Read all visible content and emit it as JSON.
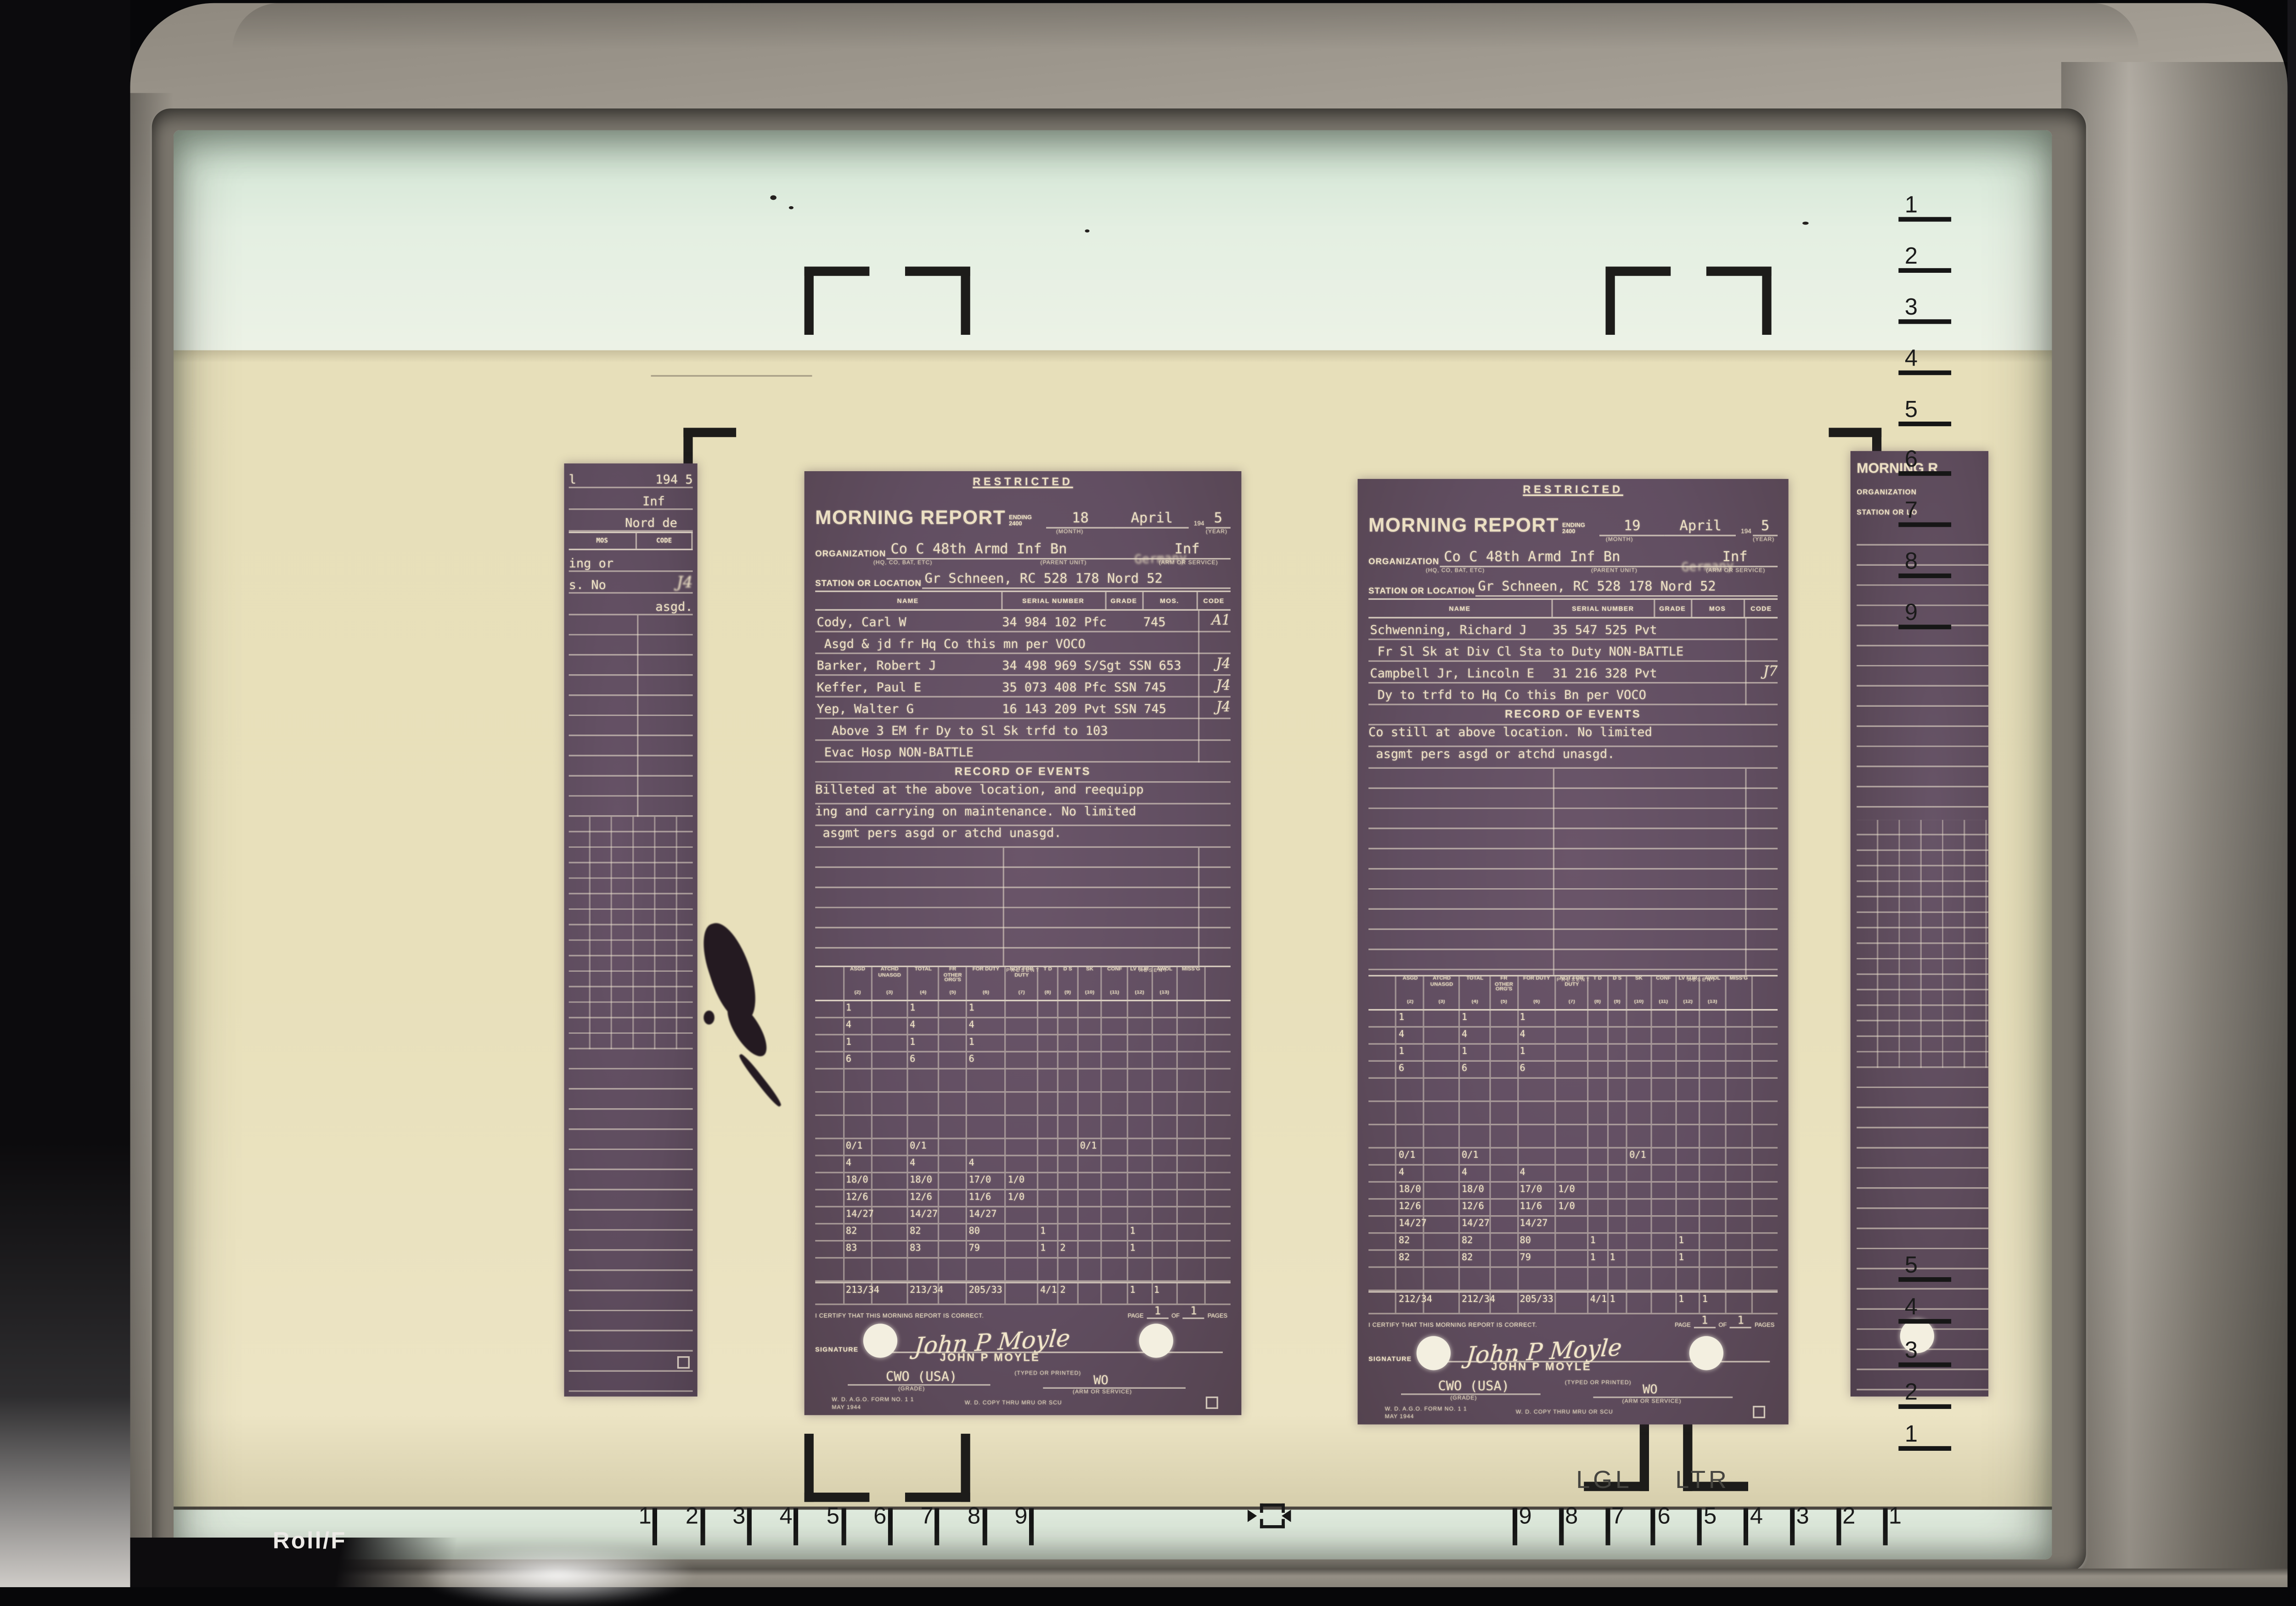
{
  "machine": {
    "roll_label": "Roll/F",
    "lgl": "LGL",
    "ltr": "LTR"
  },
  "rulers": {
    "bottom_left": [
      "1",
      "2",
      "3",
      "4",
      "5",
      "6",
      "7",
      "8",
      "9"
    ],
    "bottom_right": [
      "9",
      "8",
      "7",
      "6",
      "5",
      "4",
      "3",
      "2",
      "1"
    ],
    "right_top": [
      "1",
      "2",
      "3",
      "4",
      "5",
      "6",
      "7",
      "8",
      "9"
    ],
    "right_bottom": [
      "5",
      "4",
      "3",
      "2",
      "1"
    ]
  },
  "stats_common": {
    "present": "PRESENT",
    "absent": "ABSENT",
    "cols": [
      "ASGD",
      "ATCHD UNASGD",
      "TOTAL",
      "FR OTHER ORG'S",
      "FOR DUTY",
      "NOT FOR DUTY",
      "T D",
      "D S",
      "SK",
      "CONF",
      "LV FUR",
      "AWOL",
      "MISS'G"
    ],
    "nums": [
      "(2)",
      "(3)",
      "(4)",
      "(5)",
      "(6)",
      "(7)",
      "(8)",
      "(9)",
      "(10)",
      "(11)",
      "(12)",
      "(13)"
    ]
  },
  "doc1": {
    "classification": "RESTRICTED",
    "title": "MORNING REPORT",
    "ending": "ENDING 2400",
    "day": "18",
    "month": "April",
    "year_prefix": "194",
    "year": "5",
    "month_label": "(MONTH)",
    "year_label": "(YEAR)",
    "org_label": "ORGANIZATION",
    "org": "Co C 48th Armd Inf Bn",
    "org_sub": "(HQ, CO, BAT, ETC)",
    "parent_label": "(PARENT UNIT)",
    "arm": "Inf",
    "arm_label": "(ARM OR SERVICE)",
    "overstrike": "Germany",
    "station_label": "STATION OR LOCATION",
    "station": "Gr Schneen, RC 528 178 Nord 52",
    "cols": [
      "NAME",
      "SERIAL NUMBER",
      "GRADE",
      "MOS.",
      "CODE"
    ],
    "roster": [
      {
        "name": "Cody, Carl W",
        "serial": "34 984 102 Pfc",
        "mos": "745",
        "code": "A1"
      },
      {
        "name": " Asgd & jd fr Hq Co this mn per VOCO"
      },
      {
        "name": "Barker, Robert J",
        "serial": "34 498 969 S/Sgt SSN 653",
        "code": "J4"
      },
      {
        "name": "Keffer, Paul E",
        "serial": "35 073 408 Pfc SSN 745",
        "code": "J4"
      },
      {
        "name": "Yep, Walter G",
        "serial": "16 143 209 Pvt SSN 745",
        "code": "J4"
      },
      {
        "name": "  Above 3 EM fr Dy to Sl Sk trfd to 103"
      },
      {
        "name": " Evac Hosp NON-BATTLE"
      }
    ],
    "events_title": "RECORD OF EVENTS",
    "events": [
      "Billeted at the above location, and reequipp",
      "ing and carrying on maintenance. No limited",
      " asgmt pers asgd or atchd unasgd."
    ],
    "stats_rows": [
      [
        "1",
        "",
        "1",
        "",
        "1",
        "",
        "",
        "",
        "",
        "",
        "",
        "",
        ""
      ],
      [
        "4",
        "",
        "4",
        "",
        "4",
        "",
        "",
        "",
        "",
        "",
        "",
        "",
        ""
      ],
      [
        "1",
        "",
        "1",
        "",
        "1",
        "",
        "",
        "",
        "",
        "",
        "",
        "",
        ""
      ],
      [
        "6",
        "",
        "6",
        "",
        "6",
        "",
        "",
        "",
        "",
        "",
        "",
        "",
        ""
      ],
      [],
      [],
      [],
      [
        "0/1",
        "",
        "0/1",
        "",
        "",
        "",
        "",
        "",
        "0/1",
        "",
        "",
        "",
        ""
      ],
      [
        "4",
        "",
        "4",
        "",
        "4",
        "",
        "",
        "",
        "",
        "",
        "",
        "",
        ""
      ],
      [
        "18/0",
        "",
        "18/0",
        "",
        "17/0",
        "1/0",
        "",
        "",
        "",
        "",
        "",
        "",
        ""
      ],
      [
        "12/6",
        "",
        "12/6",
        "",
        "11/6",
        "1/0",
        "",
        "",
        "",
        "",
        "",
        "",
        ""
      ],
      [
        "14/27",
        "",
        "14/27",
        "",
        "14/27",
        "",
        "",
        "",
        "",
        "",
        "",
        "",
        ""
      ],
      [
        "82",
        "",
        "82",
        "",
        "80",
        "",
        "1",
        "",
        "",
        "",
        "1",
        "",
        ""
      ],
      [
        "83",
        "",
        "83",
        "",
        "79",
        "",
        "1",
        "2",
        "",
        "",
        "1",
        "",
        ""
      ],
      [],
      [
        "213/34",
        "",
        "213/34",
        "",
        "205/33",
        "",
        "4/1",
        "2",
        "",
        "",
        "1",
        "1",
        ""
      ]
    ],
    "certify": "I CERTIFY THAT THIS MORNING REPORT IS CORRECT.",
    "page_label": "PAGE",
    "page": "1",
    "of_label": "OF",
    "pages": "1",
    "pages_label": "PAGES",
    "signature_label": "SIGNATURE",
    "sig_script": "John P Moyle",
    "sig_typed": "JOHN P MOYLE",
    "typed_note": "(TYPED OR PRINTED)",
    "grade": "CWO (USA)",
    "grade_label": "(GRADE)",
    "svc": "WO",
    "svc_label": "(ARM OR SERVICE)",
    "form_no": "W. D. A.G.O. FORM NO. 1",
    "form_rev": "1 MAY 1944",
    "copy_note": "W. D. COPY THRU MRU OR SCU"
  },
  "doc2": {
    "classification": "RESTRICTED",
    "title": "MORNING REPORT",
    "ending": "ENDING 2400",
    "day": "19",
    "month": "April",
    "year_prefix": "194",
    "year": "5",
    "month_label": "(MONTH)",
    "year_label": "(YEAR)",
    "org_label": "ORGANIZATION",
    "org": "Co C 48th Armd Inf Bn",
    "org_sub": "(HQ, CO, BAT, ETC)",
    "parent_label": "(PARENT UNIT)",
    "arm": "Inf",
    "arm_label": "(ARM OR SERVICE)",
    "overstrike": "Germany",
    "station_label": "STATION OR LOCATION",
    "station": "Gr Schneen, RC 528 178 Nord 52",
    "cols": [
      "NAME",
      "SERIAL NUMBER",
      "GRADE",
      "MOS",
      "CODE"
    ],
    "roster": [
      {
        "name": "Schwenning, Richard J",
        "serial": "35 547 525 Pvt"
      },
      {
        "name": " Fr Sl Sk at Div Cl Sta to Duty NON-BATTLE"
      },
      {
        "name": "Campbell Jr, Lincoln E",
        "serial": "31 216 328 Pvt",
        "code": "J7"
      },
      {
        "name": " Dy to trfd to Hq Co this Bn per VOCO"
      }
    ],
    "events_title": "RECORD OF EVENTS",
    "events": [
      "Co still at above location. No limited",
      " asgmt pers asgd or atchd unasgd."
    ],
    "stats_rows": [
      [
        "1",
        "",
        "1",
        "",
        "1",
        "",
        "",
        "",
        "",
        "",
        "",
        "",
        ""
      ],
      [
        "4",
        "",
        "4",
        "",
        "4",
        "",
        "",
        "",
        "",
        "",
        "",
        "",
        ""
      ],
      [
        "1",
        "",
        "1",
        "",
        "1",
        "",
        "",
        "",
        "",
        "",
        "",
        "",
        ""
      ],
      [
        "6",
        "",
        "6",
        "",
        "6",
        "",
        "",
        "",
        "",
        "",
        "",
        "",
        ""
      ],
      [],
      [],
      [],
      [
        "0/1",
        "",
        "0/1",
        "",
        "",
        "",
        "",
        "",
        "0/1",
        "",
        "",
        "",
        ""
      ],
      [
        "4",
        "",
        "4",
        "",
        "4",
        "",
        "",
        "",
        "",
        "",
        "",
        "",
        ""
      ],
      [
        "18/0",
        "",
        "18/0",
        "",
        "17/0",
        "1/0",
        "",
        "",
        "",
        "",
        "",
        "",
        ""
      ],
      [
        "12/6",
        "",
        "12/6",
        "",
        "11/6",
        "1/0",
        "",
        "",
        "",
        "",
        "",
        "",
        ""
      ],
      [
        "14/27",
        "",
        "14/27",
        "",
        "14/27",
        "",
        "",
        "",
        "",
        "",
        "",
        "",
        ""
      ],
      [
        "82",
        "",
        "82",
        "",
        "80",
        "",
        "1",
        "",
        "",
        "",
        "1",
        "",
        ""
      ],
      [
        "82",
        "",
        "82",
        "",
        "79",
        "",
        "1",
        "1",
        "",
        "",
        "1",
        "",
        ""
      ],
      [],
      [
        "212/34",
        "",
        "212/34",
        "",
        "205/33",
        "",
        "4/1",
        "1",
        "",
        "",
        "1",
        "1",
        ""
      ]
    ],
    "certify": "I CERTIFY THAT THIS MORNING REPORT IS CORRECT.",
    "page_label": "PAGE",
    "page": "1",
    "of_label": "OF",
    "pages": "1",
    "pages_label": "PAGES",
    "signature_label": "SIGNATURE",
    "sig_script": "John P Moyle",
    "sig_typed": "JOHN P MOYLE",
    "typed_note": "(TYPED OR PRINTED)",
    "grade": "CWO (USA)",
    "grade_label": "(GRADE)",
    "svc": "WO",
    "svc_label": "(ARM OR SERVICE)",
    "form_no": "W. D. A.G.O. FORM NO. 1",
    "form_rev": "1 MAY 1944",
    "copy_note": "W. D. COPY THRU MRU OR SCU"
  },
  "left_partial": {
    "frag_day": "l",
    "frag_year": "194 5",
    "frag_arm": "Inf",
    "frag_loc": "Nord de",
    "mos": "MOS",
    "code": "CODE",
    "lines": [
      "ing or",
      "s. No",
      "asgd."
    ],
    "code_scribble": "J4"
  },
  "right_partial": {
    "title": "MORNING R",
    "org": "ORGANIZATION",
    "station": "STATION OR LO"
  }
}
